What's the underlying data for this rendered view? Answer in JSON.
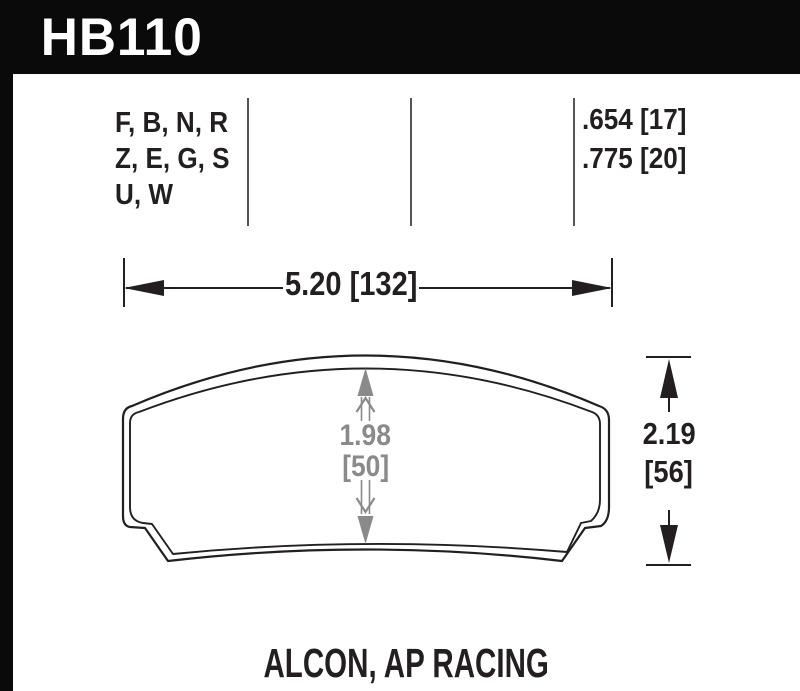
{
  "header": {
    "part_number": "HB110"
  },
  "spec_table": {
    "compounds": [
      "F, B, N, R",
      "Z, E, G, S",
      "U, W"
    ],
    "pad_thickness": [
      ".654 [17]",
      ".775 [20]"
    ]
  },
  "dimensions": {
    "width_label": "5.20 [132]",
    "height_label": [
      "2.19",
      "[56]"
    ],
    "center_height_label": [
      "1.98",
      "[50]"
    ]
  },
  "footer": {
    "applications": "ALCON, AP RACING"
  },
  "colors": {
    "bar_background": "#0a0a0a",
    "ink": "#231f20",
    "dimension_gray": "#8a8a8a",
    "divider_gray": "#555555"
  }
}
